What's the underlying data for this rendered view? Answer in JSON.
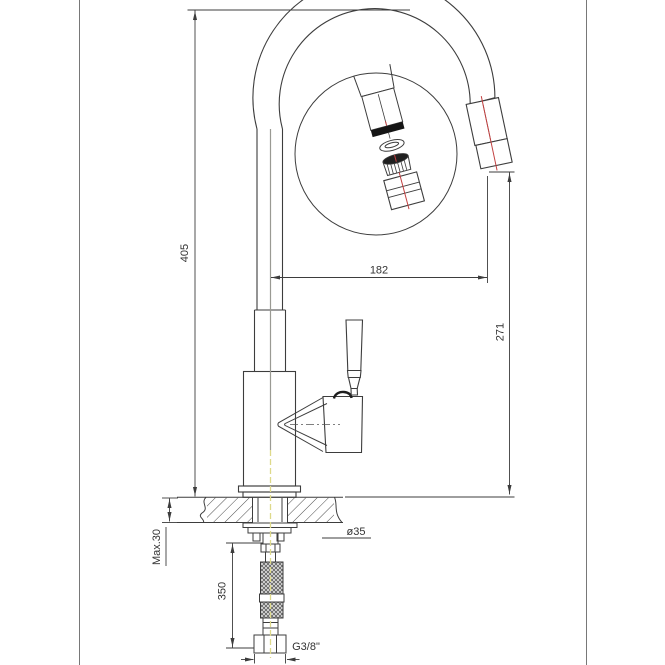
{
  "drawing": {
    "kind": "faucet-installation-technical-drawing",
    "dimensions": {
      "total_height": "405",
      "spout_reach": "182",
      "outlet_height": "271",
      "max_deck_thickness": "Max.30",
      "hose_length": "350",
      "hole_diameter": "ø35",
      "thread": "G3/8\""
    },
    "colors": {
      "line": "#3d3d3d",
      "frame": "#787878",
      "centerline_gray": "#9a9a93",
      "centerline_yellow": "#ded98a",
      "centerline_red": "#c24040",
      "background": "#ffffff"
    }
  }
}
